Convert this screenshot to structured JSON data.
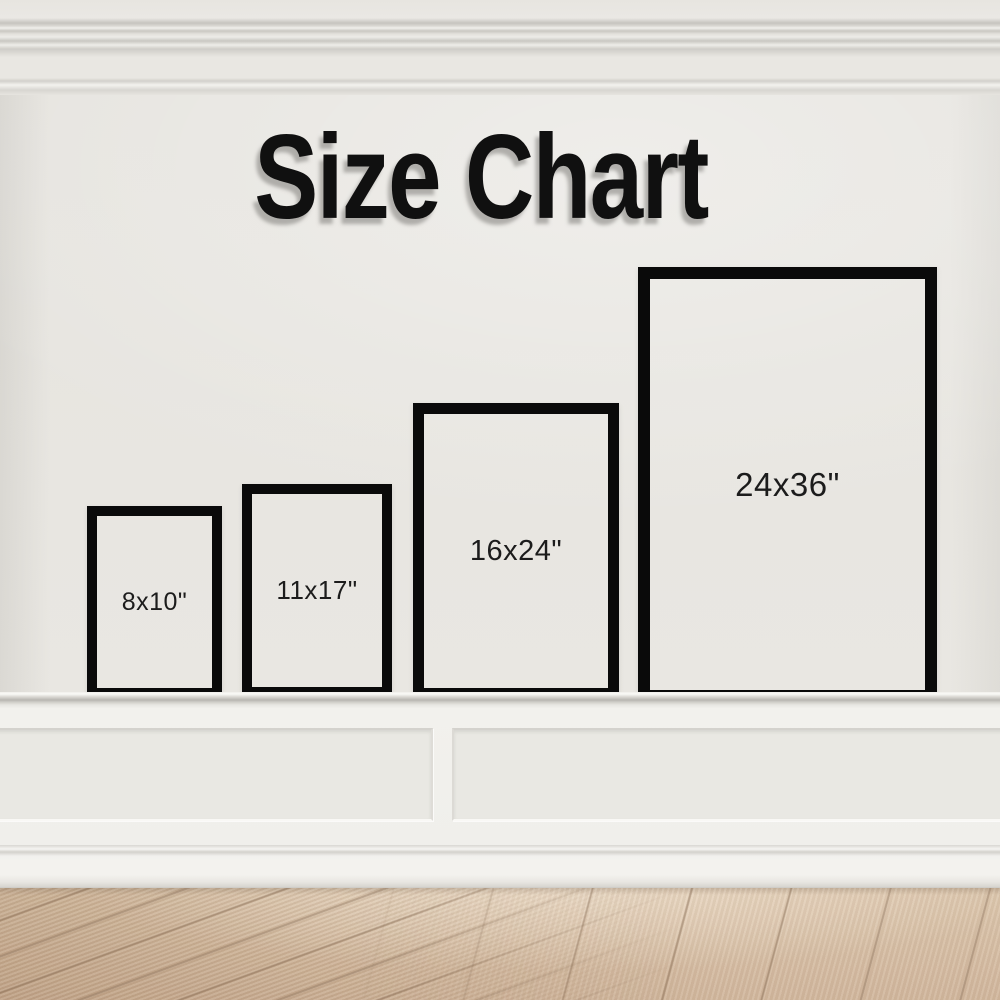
{
  "title": "Size Chart",
  "frames": [
    {
      "label": "8x10\""
    },
    {
      "label": "11x17\""
    },
    {
      "label": "16x24\""
    },
    {
      "label": "24x36\""
    }
  ],
  "colors": {
    "wall": "#e8e6e1",
    "trim_white": "#f2f1ed",
    "frame_border": "#0a0a0a",
    "label_text": "#1c1c1c",
    "title_text": "#101010",
    "floor_wood": "#cdb297"
  }
}
